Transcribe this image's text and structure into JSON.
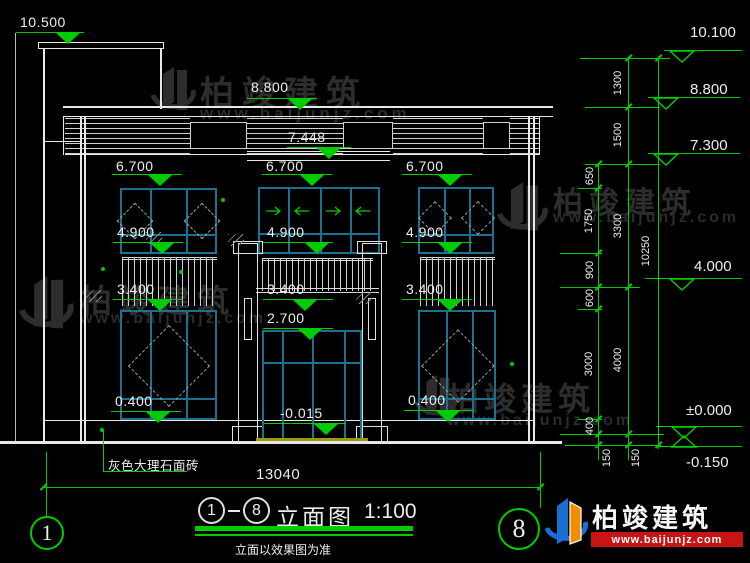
{
  "drawing_title": {
    "axis_start": "1",
    "axis_end": "8",
    "name": "立面图",
    "scale": "1:100",
    "note": "立面以效果图为准"
  },
  "facade_markers": [
    {
      "id": "tower-top",
      "value": "10.500"
    },
    {
      "id": "roof",
      "value": "8.800"
    },
    {
      "id": "canopy",
      "value": "7.448"
    },
    {
      "id": "level-6700-left",
      "value": "6.700"
    },
    {
      "id": "level-6700-middle",
      "value": "6.700"
    },
    {
      "id": "level-6700-right",
      "value": "6.700"
    },
    {
      "id": "level-4900-left",
      "value": "4.900"
    },
    {
      "id": "level-4900-middle",
      "value": "4.900"
    },
    {
      "id": "level-4900-right",
      "value": "4.900"
    },
    {
      "id": "level-3400-left",
      "value": "3.400"
    },
    {
      "id": "level-3400-middle",
      "value": "3.400"
    },
    {
      "id": "level-3400-right",
      "value": "3.400"
    },
    {
      "id": "level-2700",
      "value": "2.700"
    },
    {
      "id": "level-0400-left",
      "value": "0.400"
    },
    {
      "id": "level-0400-right",
      "value": "0.400"
    },
    {
      "id": "entrance",
      "value": "-0.015"
    }
  ],
  "right_markers": [
    {
      "id": "parapet",
      "value": "10.100"
    },
    {
      "id": "roof",
      "value": "8.800"
    },
    {
      "id": "band",
      "value": "7.300"
    },
    {
      "id": "mid",
      "value": "4.000"
    },
    {
      "id": "ground",
      "value": "±0.000"
    },
    {
      "id": "site",
      "value": "-0.150"
    }
  ],
  "dimensions": {
    "chain_inner": [
      "650",
      "1750",
      "900",
      "600",
      "3000",
      "400",
      "150"
    ],
    "chain_middle": [
      "1300",
      "1500",
      "3300",
      "4000",
      "150"
    ],
    "total_height": "10250",
    "overall_width": "13040"
  },
  "labels": {
    "material": "灰色大理石面砖"
  },
  "axis_bubbles": {
    "left": "1",
    "right": "8"
  },
  "branding": {
    "name": "柏竣建筑",
    "url": "www.baijunjz.com"
  },
  "watermark": {
    "name": "柏竣建筑",
    "url": "www.baijunjz.com"
  },
  "colors": {
    "dim_green": "#00cc00",
    "line_white": "#e8e8e8",
    "window_teal": "#1e708f",
    "threshold_yellow": "#9a9a12",
    "logo_blue": "#1a6fd4",
    "logo_orange": "#f28c00",
    "url_bar_red": "#c81414",
    "watermark_gray": "#2d2d2d"
  }
}
